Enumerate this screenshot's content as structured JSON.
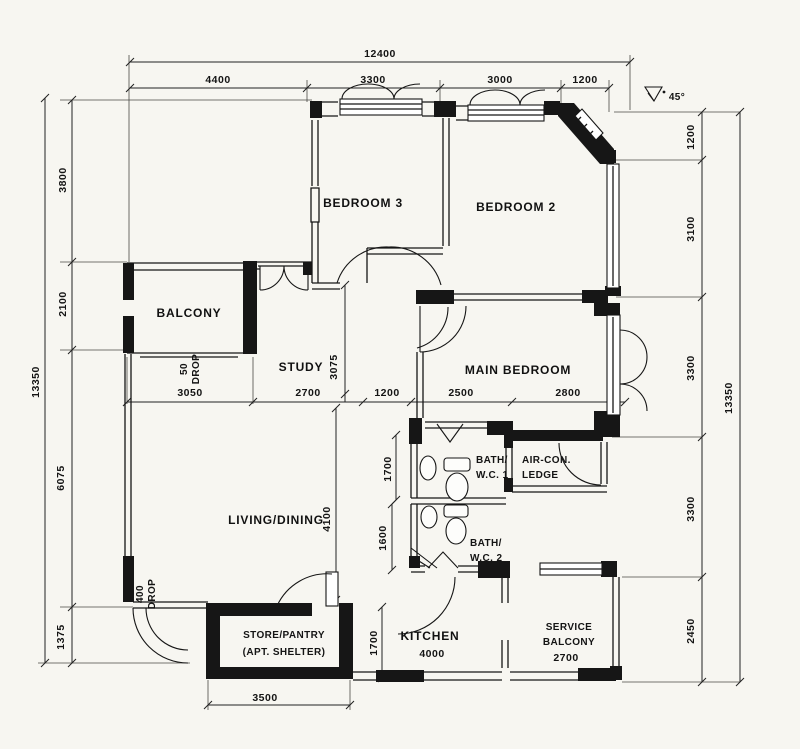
{
  "colors": {
    "ink": "#161616",
    "paper": "#f7f6f1"
  },
  "rooms": {
    "bedroom3": {
      "label": "BEDROOM 3"
    },
    "bedroom2": {
      "label": "BEDROOM 2"
    },
    "main_bedroom": {
      "label": "MAIN BEDROOM"
    },
    "balcony": {
      "label": "BALCONY"
    },
    "study": {
      "label": "STUDY"
    },
    "living_dining": {
      "label": "LIVING/DINING"
    },
    "bath_wc1": {
      "line1": "BATH/",
      "line2": "W.C. 1"
    },
    "bath_wc2": {
      "line1": "BATH/",
      "line2": "W.C. 2"
    },
    "aircon_ledge": {
      "line1": "AIR-CON.",
      "line2": "LEDGE"
    },
    "store_pantry": {
      "line1": "STORE/PANTRY",
      "line2": "(APT. SHELTER)"
    },
    "kitchen": {
      "label": "KITCHEN",
      "width": "4000"
    },
    "service_balcony": {
      "line1": "SERVICE",
      "line2": "BALCONY",
      "width": "2700"
    }
  },
  "dims": {
    "top_overall": "12400",
    "top_segments": [
      "4400",
      "3300",
      "3000",
      "1200"
    ],
    "left_overall": "13350",
    "left_segments": [
      "3800",
      "2100",
      "6075",
      "1375"
    ],
    "right_overall": "13350",
    "right_segments": [
      "1200",
      "3100",
      "3300",
      "3300",
      "2450"
    ],
    "mid_row": [
      "3050",
      "2700",
      "1200",
      "2500",
      "2800"
    ],
    "study_depth": "3075",
    "living_depth": "4100",
    "bath1_depth": "1700",
    "bath2_depth": "1600",
    "store_depth": "1700",
    "store_width": "3500"
  },
  "annotations": {
    "drop_50_line1": "50",
    "drop_50_line2": "DROP",
    "drop_400_line1": "400",
    "drop_400_line2": "DROP",
    "angle": "45°"
  }
}
